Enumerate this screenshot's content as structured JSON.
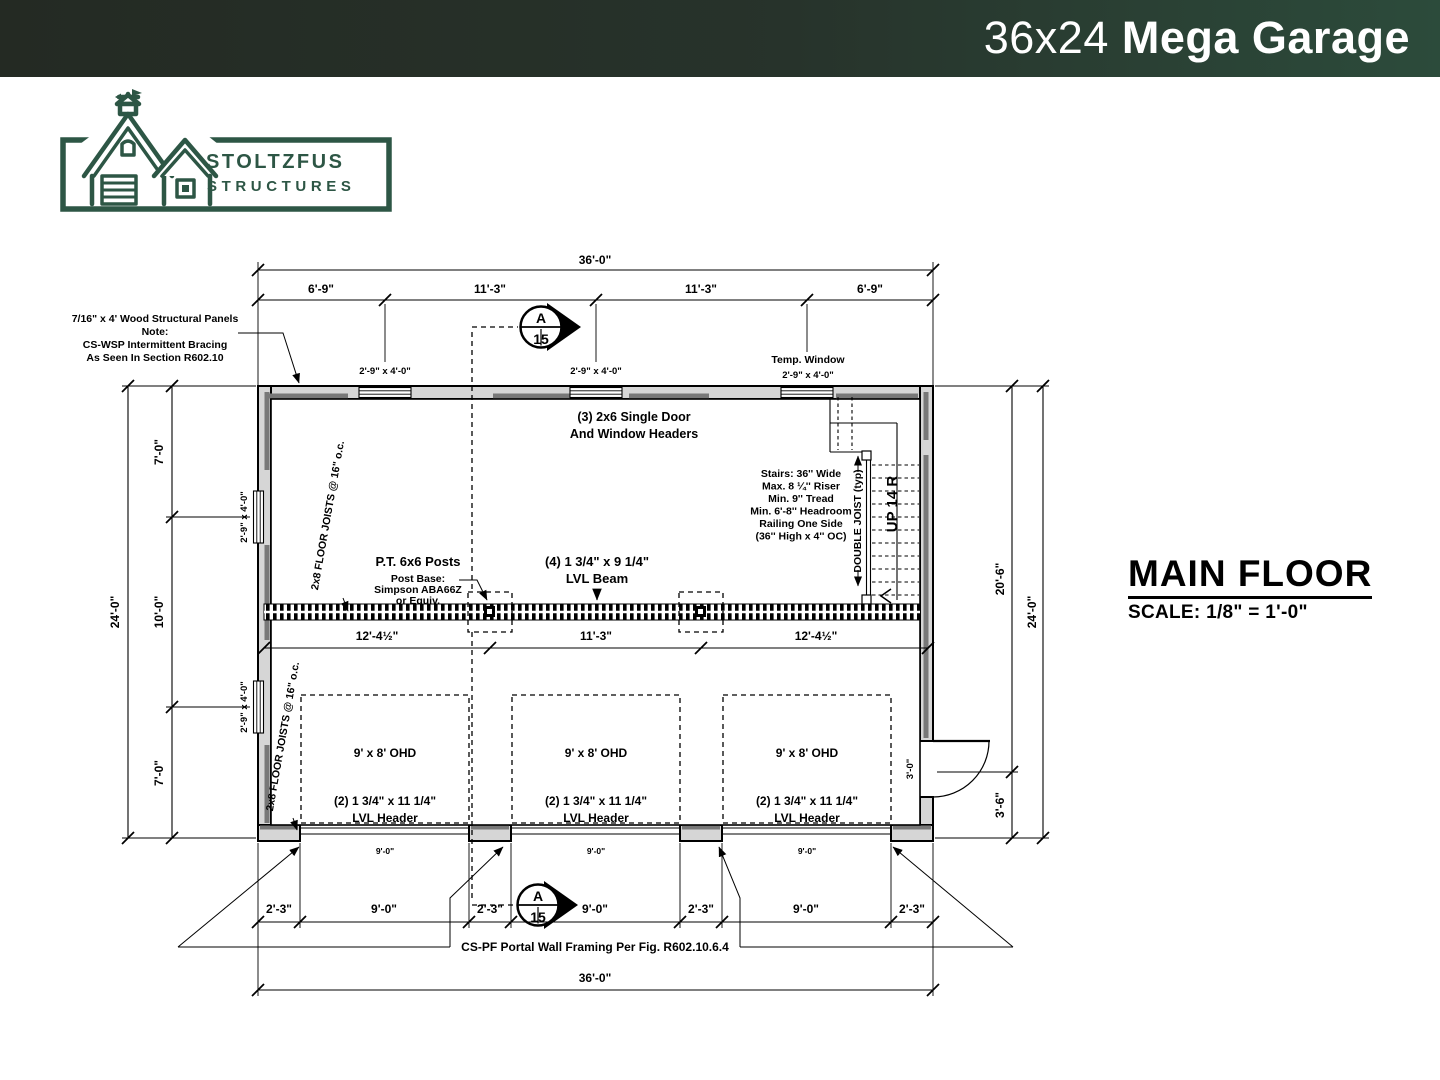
{
  "header": {
    "title_light": "36x24",
    "title_bold": "Mega Garage"
  },
  "logo": {
    "name_line1": "STOLTZFUS",
    "name_line2": "STRUCTURES"
  },
  "title_block": {
    "title": "MAIN FLOOR",
    "scale": "SCALE: 1/8\" = 1'-0\""
  },
  "plan": {
    "dims": {
      "top_overall": "36'-0\"",
      "top_segments": [
        "6'-9\"",
        "11'-3\"",
        "11'-3\"",
        "6'-9\""
      ],
      "left_overall": "24'-0\"",
      "left_segments": [
        "7'-0\"",
        "10'-0\"",
        "7'-0\""
      ],
      "right_overall": "24'-0\"",
      "right_segments": [
        "20'-6\"",
        "3'-6\""
      ],
      "bottom_overall": "36'-0\"",
      "bottom_segments": [
        "2'-3\"",
        "9'-0\"",
        "2'-3\"",
        "9'-0\"",
        "2'-3\"",
        "9'-0\"",
        "2'-3\""
      ],
      "interior_segments": [
        "12'-4½\"",
        "11'-3\"",
        "12'-4½\""
      ],
      "door_opening_widths": [
        "9'-0\"",
        "9'-0\"",
        "9'-0\""
      ],
      "entry_door": "3'-0\""
    },
    "windows": {
      "size_label": "2'-9\" x 4'-0\"",
      "temp_label": "Temp. Window"
    },
    "notes": {
      "wsp": [
        "7/16\" x 4' Wood Structural Panels",
        "Note:",
        "CS-WSP Intermittent Bracing",
        "As Seen In Section R602.10"
      ],
      "door_window_headers": [
        "(3) 2x6 Single Door",
        "And Window Headers"
      ],
      "floor_joists": "2x8 FLOOR JOISTS @ 16\" o.c.",
      "posts_title": "P.T. 6x6 Posts",
      "posts_sub": [
        "Post Base:",
        "Simpson ABA66Z",
        "or Equiv."
      ],
      "lvl_beam": [
        "(4) 1 3/4\" x 9 1/4\"",
        "LVL Beam"
      ],
      "stairs": [
        "Stairs: 36'' Wide",
        "Max. 8 ¼'' Riser",
        "Min. 9'' Tread",
        "Min. 6'-8'' Headroom",
        "Railing One Side",
        "(36'' High x 4'' OC)"
      ],
      "double_joist": "DOUBLE JOIST (typ)",
      "stair_direction": "UP 14 R",
      "ohd_label": "9' x 8' OHD",
      "lvl_header": [
        "(2) 1 3/4\" x 11 1/4\"",
        "LVL Header"
      ],
      "portal": "CS-PF Portal Wall Framing Per Fig. R602.10.6.4"
    },
    "section_marker": {
      "letter": "A",
      "number": "15"
    }
  },
  "colors": {
    "header_green_dark": "#242A23",
    "header_green": "#2C4B3B",
    "logo_green": "#2D5645",
    "wall_fill": "#D6D6D6",
    "panel_gray": "#787878"
  }
}
